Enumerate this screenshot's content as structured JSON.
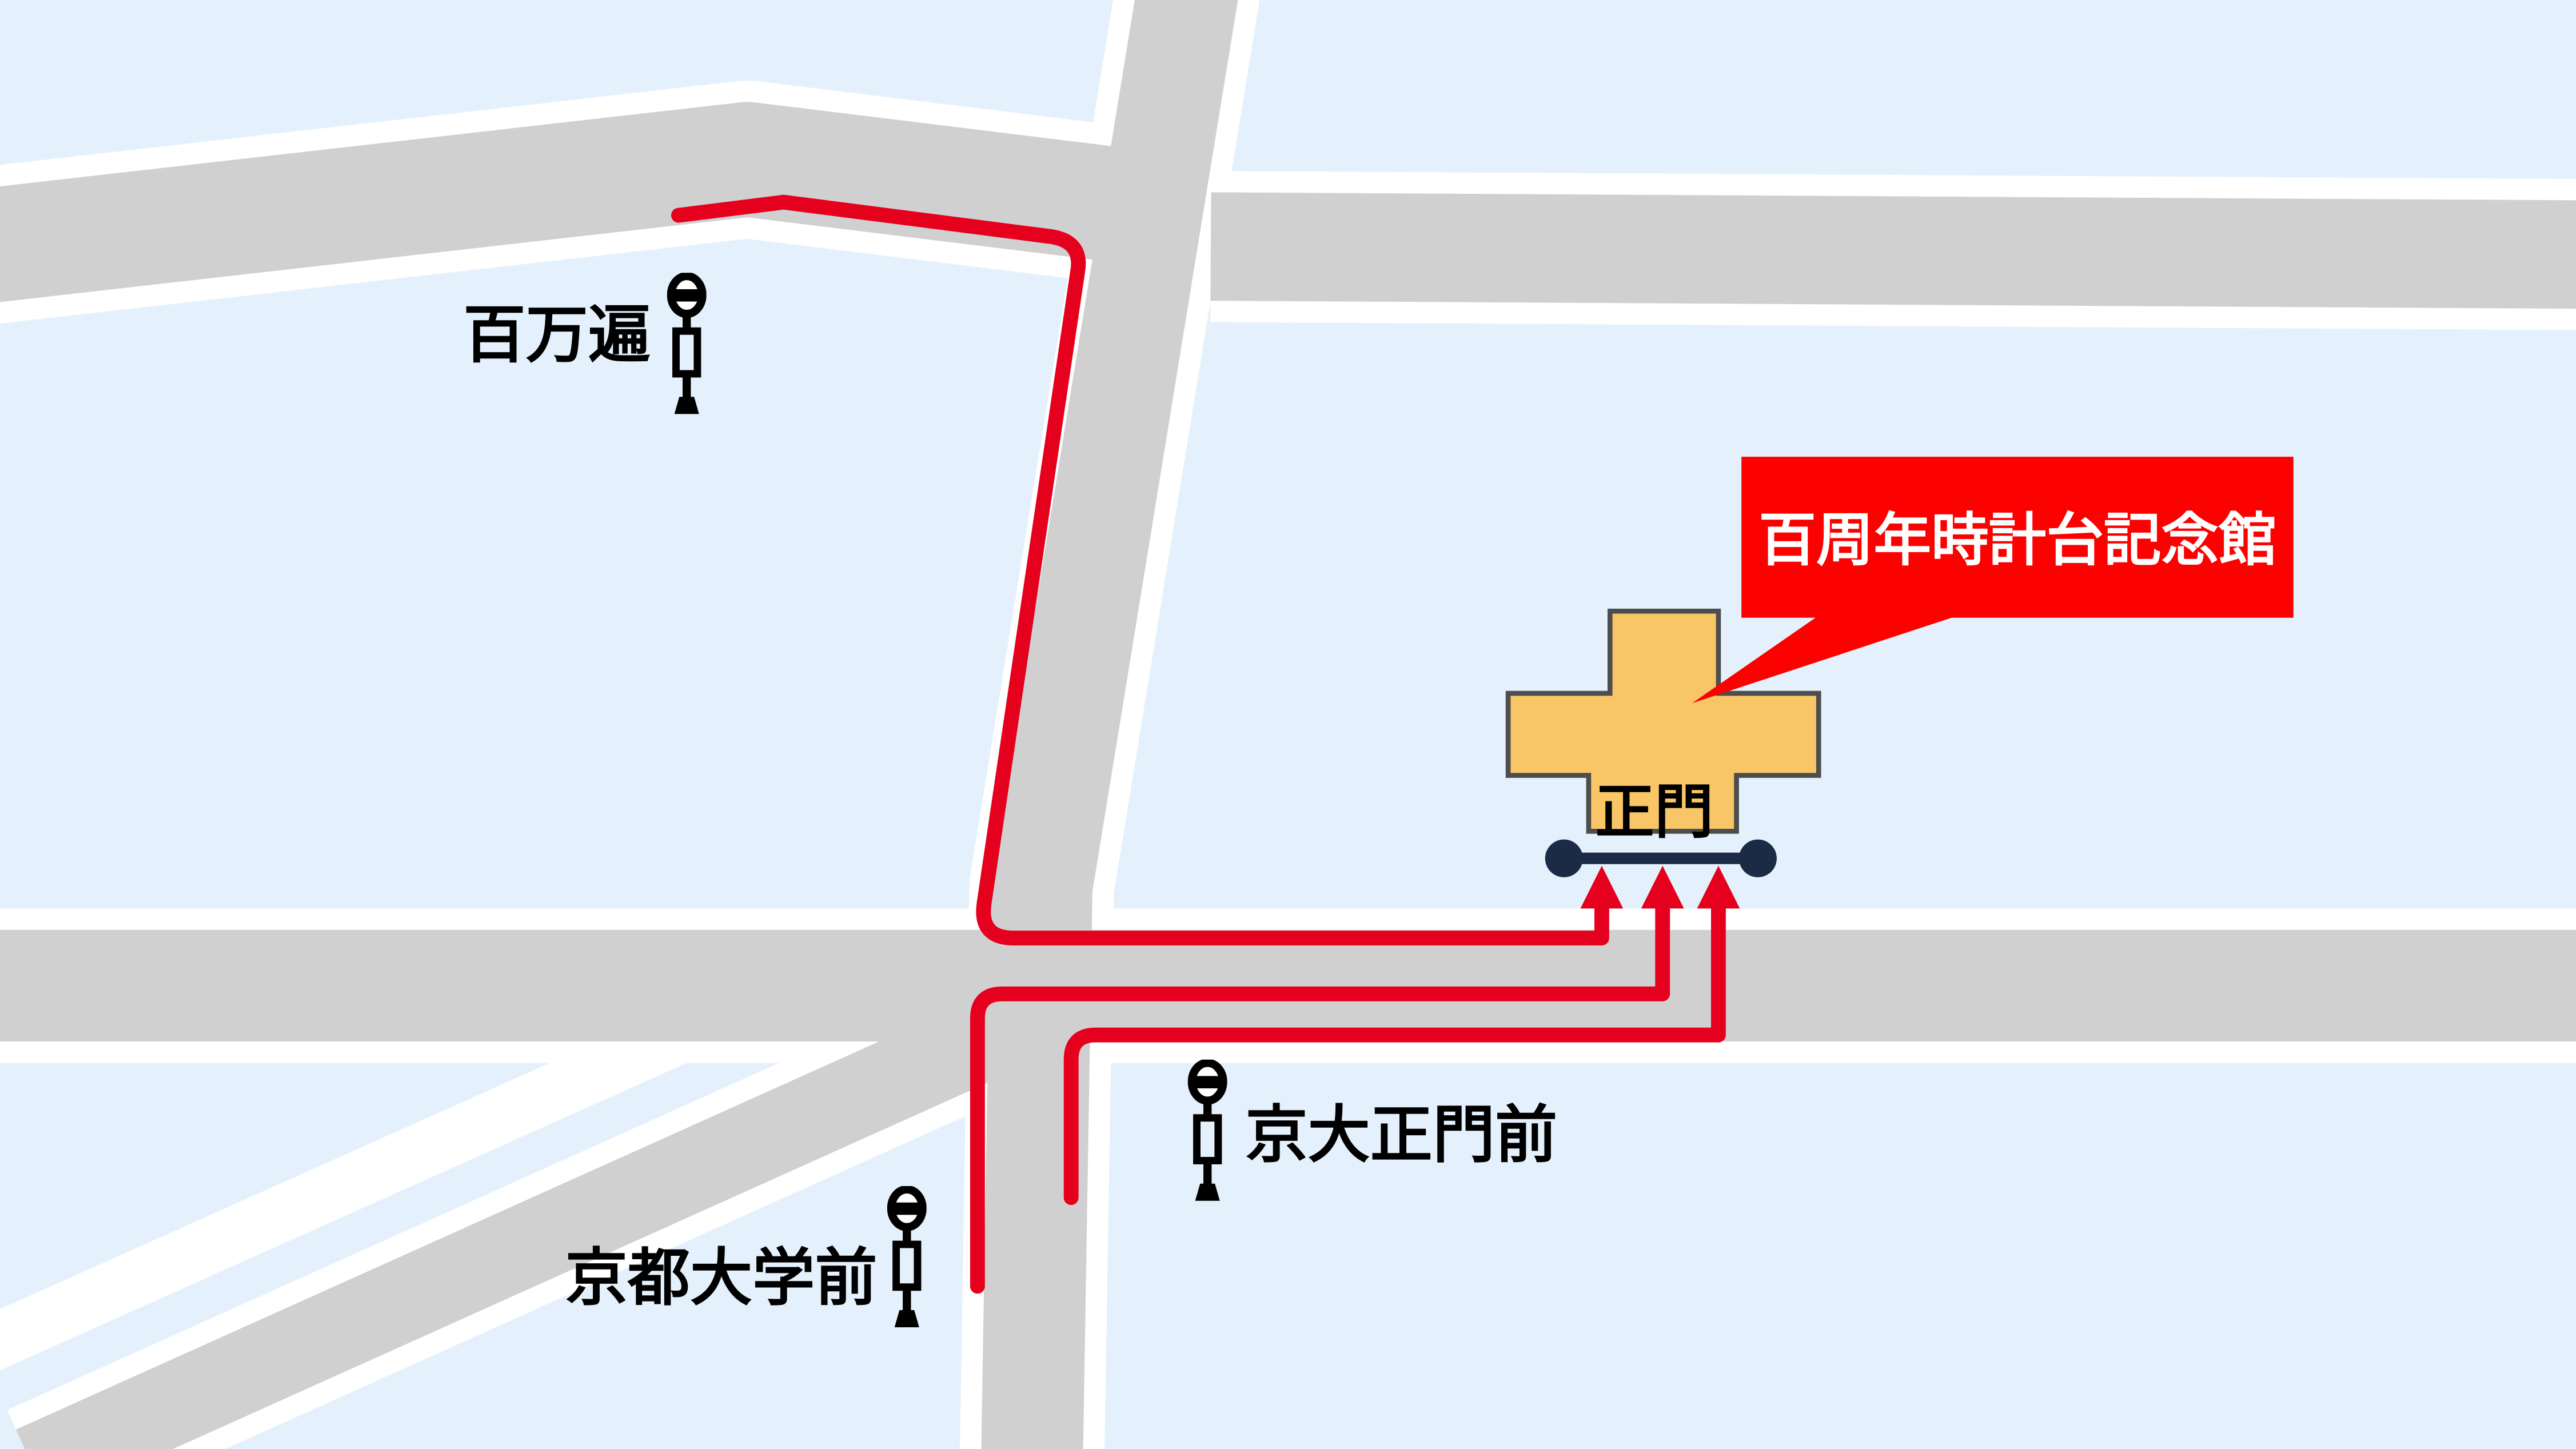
{
  "colors": {
    "background": "#E4F1FC",
    "road": "#D0D0D0",
    "casing": "#FFFFFF",
    "route": "#E5001E",
    "gate": "#1C2B45",
    "building": "#F8C567",
    "building_outline": "#4D4D4D",
    "callout_bg": "#FB0201",
    "callout_text": "#FFFFFF",
    "label_text": "#000000"
  },
  "callout": {
    "label": "百周年時計台記念館"
  },
  "gate": {
    "label": "正門"
  },
  "stops": [
    {
      "id": "hyakumanben",
      "name": "百万遍"
    },
    {
      "id": "kyodai-seimon-mae",
      "name": "京大正門前"
    },
    {
      "id": "kyoto-daigaku-mae",
      "name": "京都大学前"
    }
  ]
}
